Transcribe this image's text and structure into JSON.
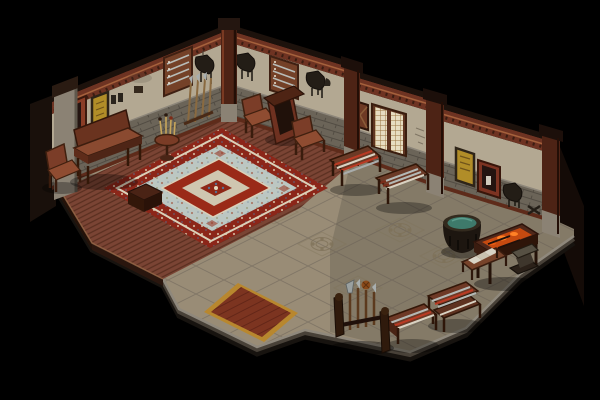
{
  "scene": {
    "title": "isometric-armory-room",
    "description": "Isometric game screenshot of a Chinese-style weapon shop interior: raised wooden dais with ornate carpet on the left, stone tile floor on the right, weapon racks, forge table and cauldron along the walls, black void outside the room.",
    "view": "isometric",
    "background": "#000000"
  },
  "palette": {
    "background": "#000000",
    "plaster": "#b3a892",
    "wainscot": "#6b6458",
    "cornice": "#6e3322",
    "cornice_cap": "#1d120c",
    "cornice_highlight": "#a5613c",
    "base_trim": "#5e2b1a",
    "pillar_wood": "#4d2315",
    "pillar_stone": "#8b8274",
    "wood_floor": "#7a4434",
    "stone_floor": "#998c76",
    "stone_floor_dark": "#5f594d",
    "edge_trim": "#8f887c",
    "edge_face": "#3f3930",
    "carpet_border": "#8c2619",
    "carpet_line": "#dbd0b8",
    "carpet_field": "#bcc7c2",
    "carpet_medallion": "#9a2a18",
    "carpet_medallion_inner": "#cfc6b0",
    "carpet_core": "#8e2717",
    "mat_gold": "#b8872e",
    "mat_red": "#7c3420",
    "scroll_yellow": "#b18d28",
    "lattice": "#e6dcc0",
    "red_panel_frame": "#8a3d26",
    "panel_dark": "#241410",
    "furniture_wood": "#7b3d28",
    "furniture_wood_light": "#8f4c31",
    "table_wood": "#6b3a26",
    "rack_dark": "#2f1a0c",
    "weapon_steel": "#b4b8b4",
    "weapon_red": "#b23a22",
    "cloth_white": "#d8d3c5",
    "cauldron_body": "#1d1610",
    "cauldron_water": "#3e7a6b",
    "ember": "#c64a10",
    "ember_bright": "#ff8126",
    "anvil_grey": "#565043",
    "saddle_dark": "#231d16"
  },
  "room": {
    "walls": [
      {
        "id": "wall-northwest",
        "label": "northwest wall with weapon boards and scrolls"
      },
      {
        "id": "wall-northeast",
        "label": "northeast wall with lattice window, scrolls and hanging tack"
      }
    ],
    "floor": [
      {
        "id": "wooden-dais",
        "label": "raised wooden plank dais"
      },
      {
        "id": "stone-floor",
        "label": "stone tile floor with carved medallion tiles"
      },
      {
        "id": "carpet",
        "label": "large ornate red and pale-blue carpet"
      },
      {
        "id": "entrance-mat",
        "label": "red entrance mat with gold border"
      }
    ]
  },
  "objects": [
    {
      "id": "altar-table",
      "label": "long wooden altar table against left wall"
    },
    {
      "id": "armchair-left",
      "label": "wooden armchair (west corner)"
    },
    {
      "id": "brush-stand",
      "label": "round stand with brushes"
    },
    {
      "id": "spear-rack-wall",
      "label": "spears leaning at wall corner"
    },
    {
      "id": "storage-box",
      "label": "dark storage box"
    },
    {
      "id": "armchair-north-1",
      "label": "wooden armchair north-east wall"
    },
    {
      "id": "shrine-cabinet",
      "label": "tall dark cabinet"
    },
    {
      "id": "armchair-north-2",
      "label": "second wooden armchair"
    },
    {
      "id": "weapon-table-striped",
      "label": "display table with striped polearms"
    },
    {
      "id": "weapon-table-swords",
      "label": "display table with swords"
    },
    {
      "id": "cauldron",
      "label": "large cauldron with green water"
    },
    {
      "id": "forge-table",
      "label": "forge table with glowing embers"
    },
    {
      "id": "cloth-bench",
      "label": "bench with folded white cloth"
    },
    {
      "id": "anvil",
      "label": "anvil on block"
    },
    {
      "id": "weapon-table-tiered",
      "label": "two-tier weapon display rack"
    },
    {
      "id": "weapon-table-front",
      "label": "front weapon display table"
    },
    {
      "id": "polearm-rack",
      "label": "standing polearm rack with halberd and tassel spear"
    }
  ],
  "wall_decor": [
    {
      "id": "red-panel-1",
      "label": "red framed wall panel (NW wall)"
    },
    {
      "id": "scroll-1",
      "label": "yellow hanging scroll (NW wall)"
    },
    {
      "id": "sword-board-1",
      "label": "sword display board (NW wall)"
    },
    {
      "id": "saddle-1",
      "label": "hanging saddle and tack (NW wall)"
    },
    {
      "id": "saddle-2",
      "label": "hanging tack (NE wall)"
    },
    {
      "id": "sword-board-2",
      "label": "sword display board (NE wall)"
    },
    {
      "id": "saddle-3",
      "label": "hanging tack pair (NE wall)"
    },
    {
      "id": "x-panel",
      "label": "small braced wooden panel"
    },
    {
      "id": "lattice-window",
      "label": "cream lattice window"
    },
    {
      "id": "scroll-2",
      "label": "yellow hanging scroll (NE wall)"
    },
    {
      "id": "red-panel-2",
      "label": "red framed panel with white tag"
    },
    {
      "id": "saddle-4",
      "label": "hanging saddle (east end)"
    }
  ]
}
